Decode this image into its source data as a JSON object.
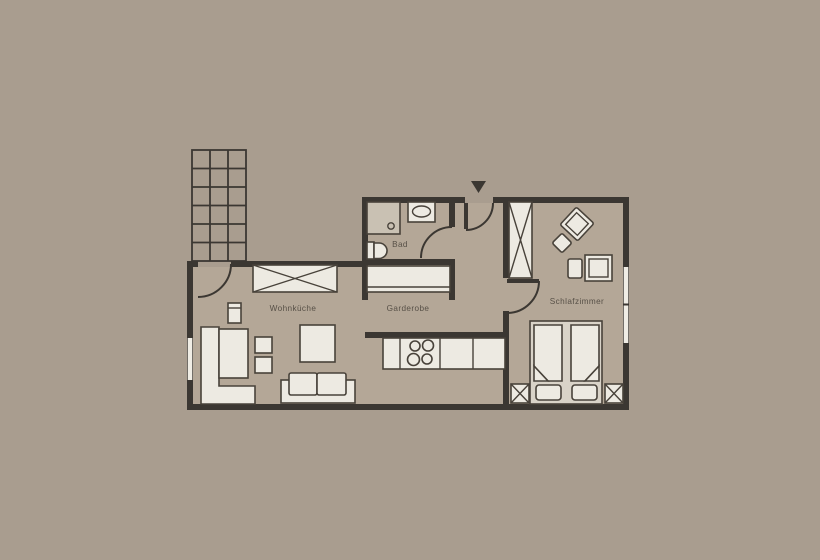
{
  "floorplan": {
    "title": "apartment-floor-plan",
    "rooms": [
      {
        "id": "wohnkueche",
        "label": "Wohnküche"
      },
      {
        "id": "garderobe",
        "label": "Garderobe"
      },
      {
        "id": "bad",
        "label": "Bad"
      },
      {
        "id": "schlafzimmer",
        "label": "Schlafzimmer"
      }
    ],
    "icons": {
      "entry_arrow": "▼"
    },
    "colors": {
      "background": "#a99d8f",
      "floor": "#b4a797",
      "wall": "#3b3732",
      "furniture_fill": "#edeae2",
      "furniture_border": "#48423a",
      "shower_fill": "#c9c1b3",
      "bedframe_fill": "#d9d3c8",
      "window": "#f0ede5",
      "text": "#575047"
    }
  }
}
